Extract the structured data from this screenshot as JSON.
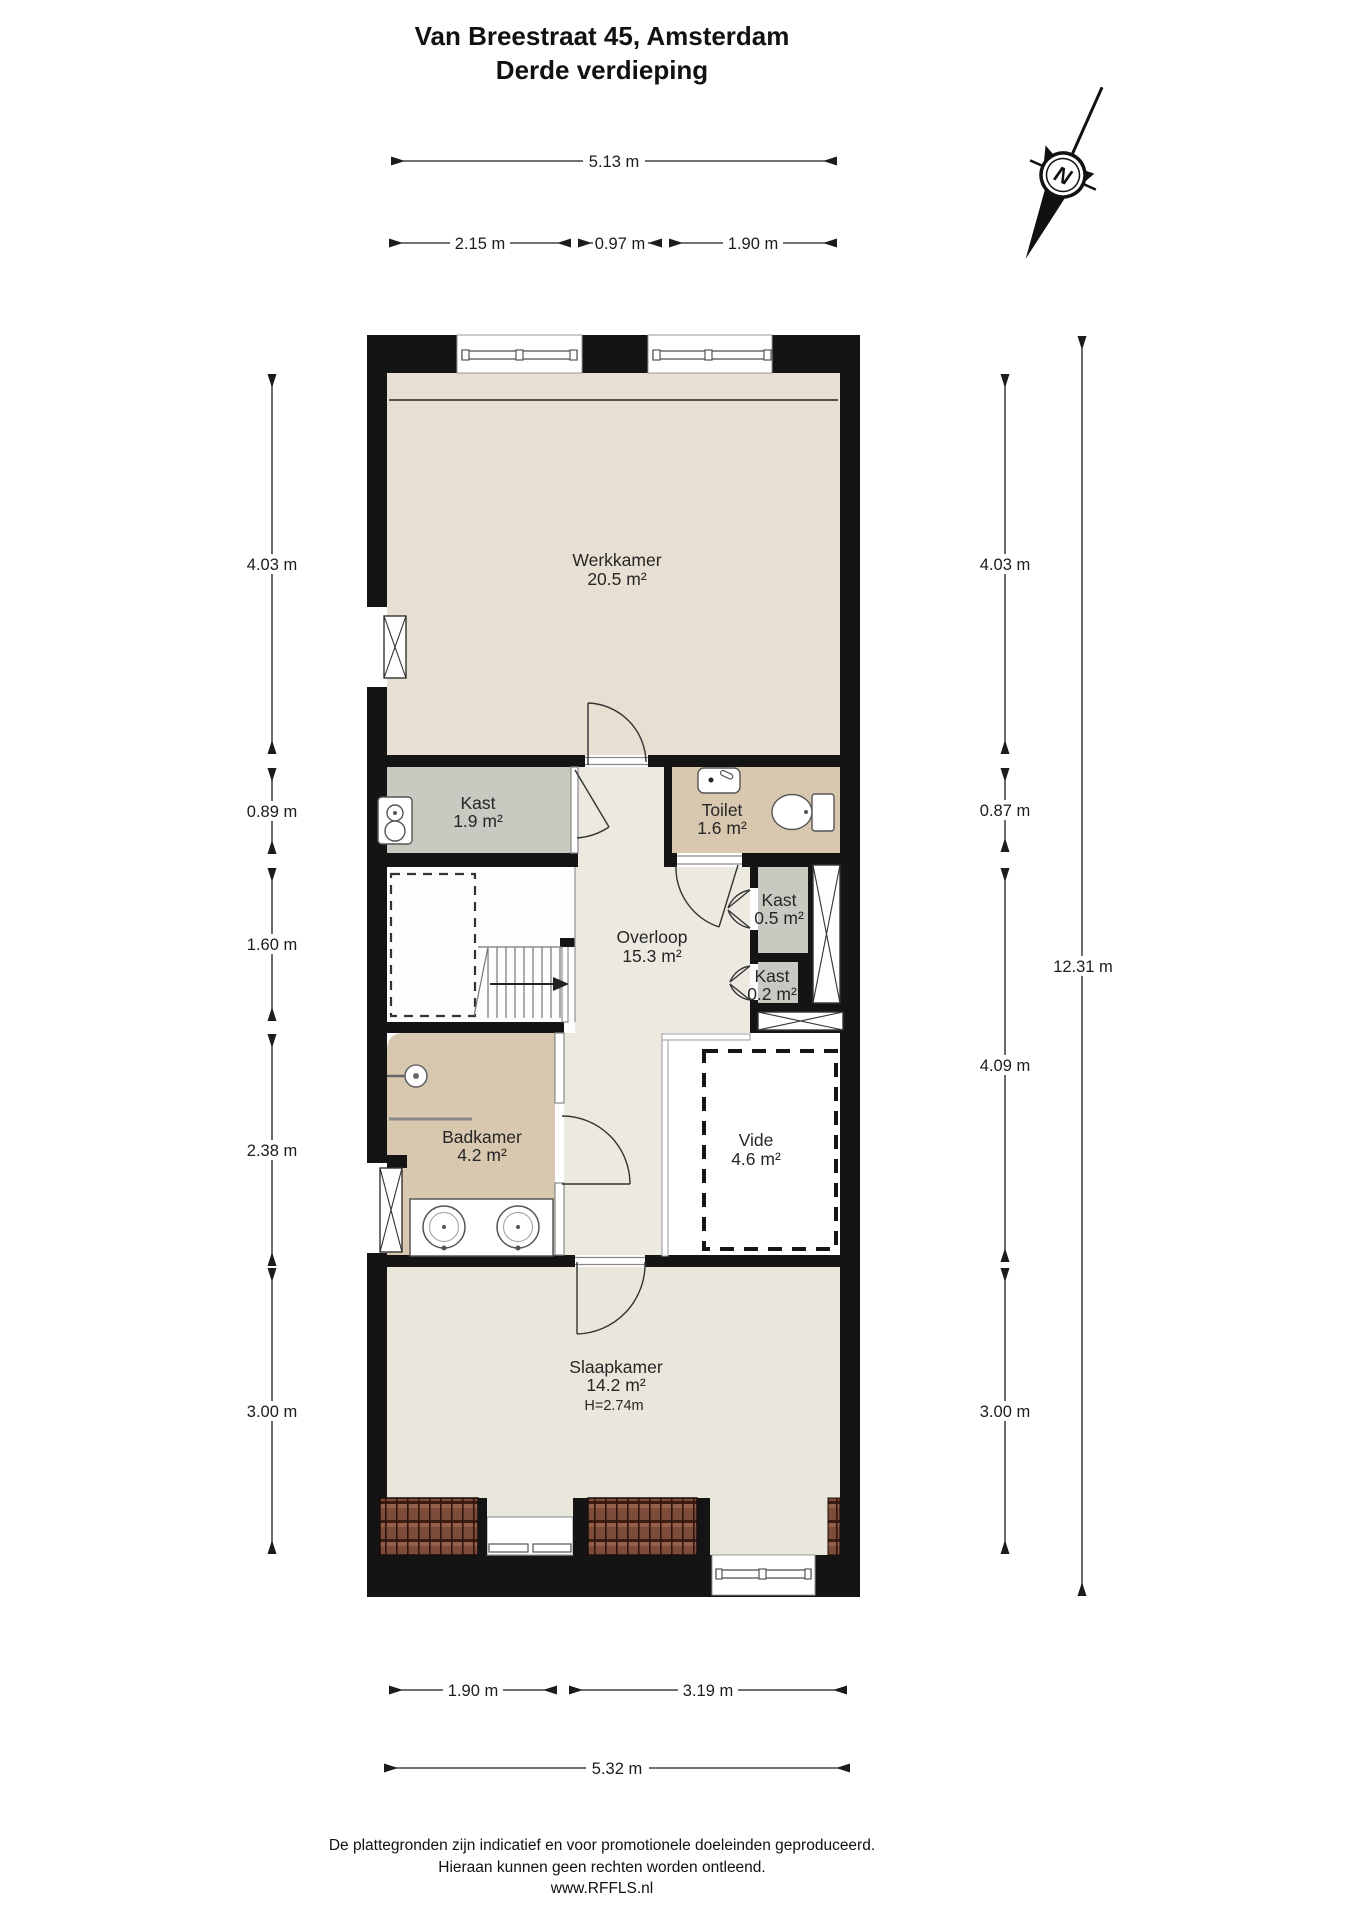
{
  "title": {
    "line1": "Van Breestraat 45, Amsterdam",
    "line2": "Derde verdieping"
  },
  "compass": {
    "north_label": "N"
  },
  "rooms": {
    "werkkamer": {
      "name": "Werkkamer",
      "area": "20.5 m²"
    },
    "kast_groot": {
      "name": "Kast",
      "area": "1.9 m²"
    },
    "toilet": {
      "name": "Toilet",
      "area": "1.6 m²"
    },
    "kast_05": {
      "name": "Kast",
      "area": "0.5 m²"
    },
    "kast_02": {
      "name": "Kast",
      "area": "0.2 m²"
    },
    "overloop": {
      "name": "Overloop",
      "area": "15.3 m²"
    },
    "badkamer": {
      "name": "Badkamer",
      "area": "4.2 m²"
    },
    "vide": {
      "name": "Vide",
      "area": "4.6 m²"
    },
    "slaapkamer": {
      "name": "Slaapkamer",
      "area": "14.2 m²",
      "height": "H=2.74m"
    }
  },
  "dimensions": {
    "top_total": "5.13 m",
    "top_segments": [
      "2.15 m",
      "0.97 m",
      "1.90 m"
    ],
    "left": [
      "4.03 m",
      "0.89 m",
      "1.60 m",
      "2.38 m",
      "3.00 m"
    ],
    "right": [
      "4.03 m",
      "0.87 m",
      "4.09 m",
      "3.00 m"
    ],
    "right_total": "12.31 m",
    "bottom_segments": [
      "1.90 m",
      "3.19 m"
    ],
    "bottom_total": "5.32 m"
  },
  "footer": {
    "line1": "De plattegronden zijn indicatief en voor promotionele doeleinden geproduceerd.",
    "line2": "Hieraan kunnen geen rechten worden ontleend.",
    "line3": "www.RFFLS.nl"
  },
  "colors": {
    "wall": "#141414",
    "werkkamer_fill": "#E7DFD1",
    "slaapkamer_fill": "#E9E6DB",
    "overloop_fill": "#EBE9E0",
    "bad_toilet_fill": "#D9C8B0",
    "kast_fill": "#C6CAC1",
    "roof_tile": "#7D4B39"
  }
}
